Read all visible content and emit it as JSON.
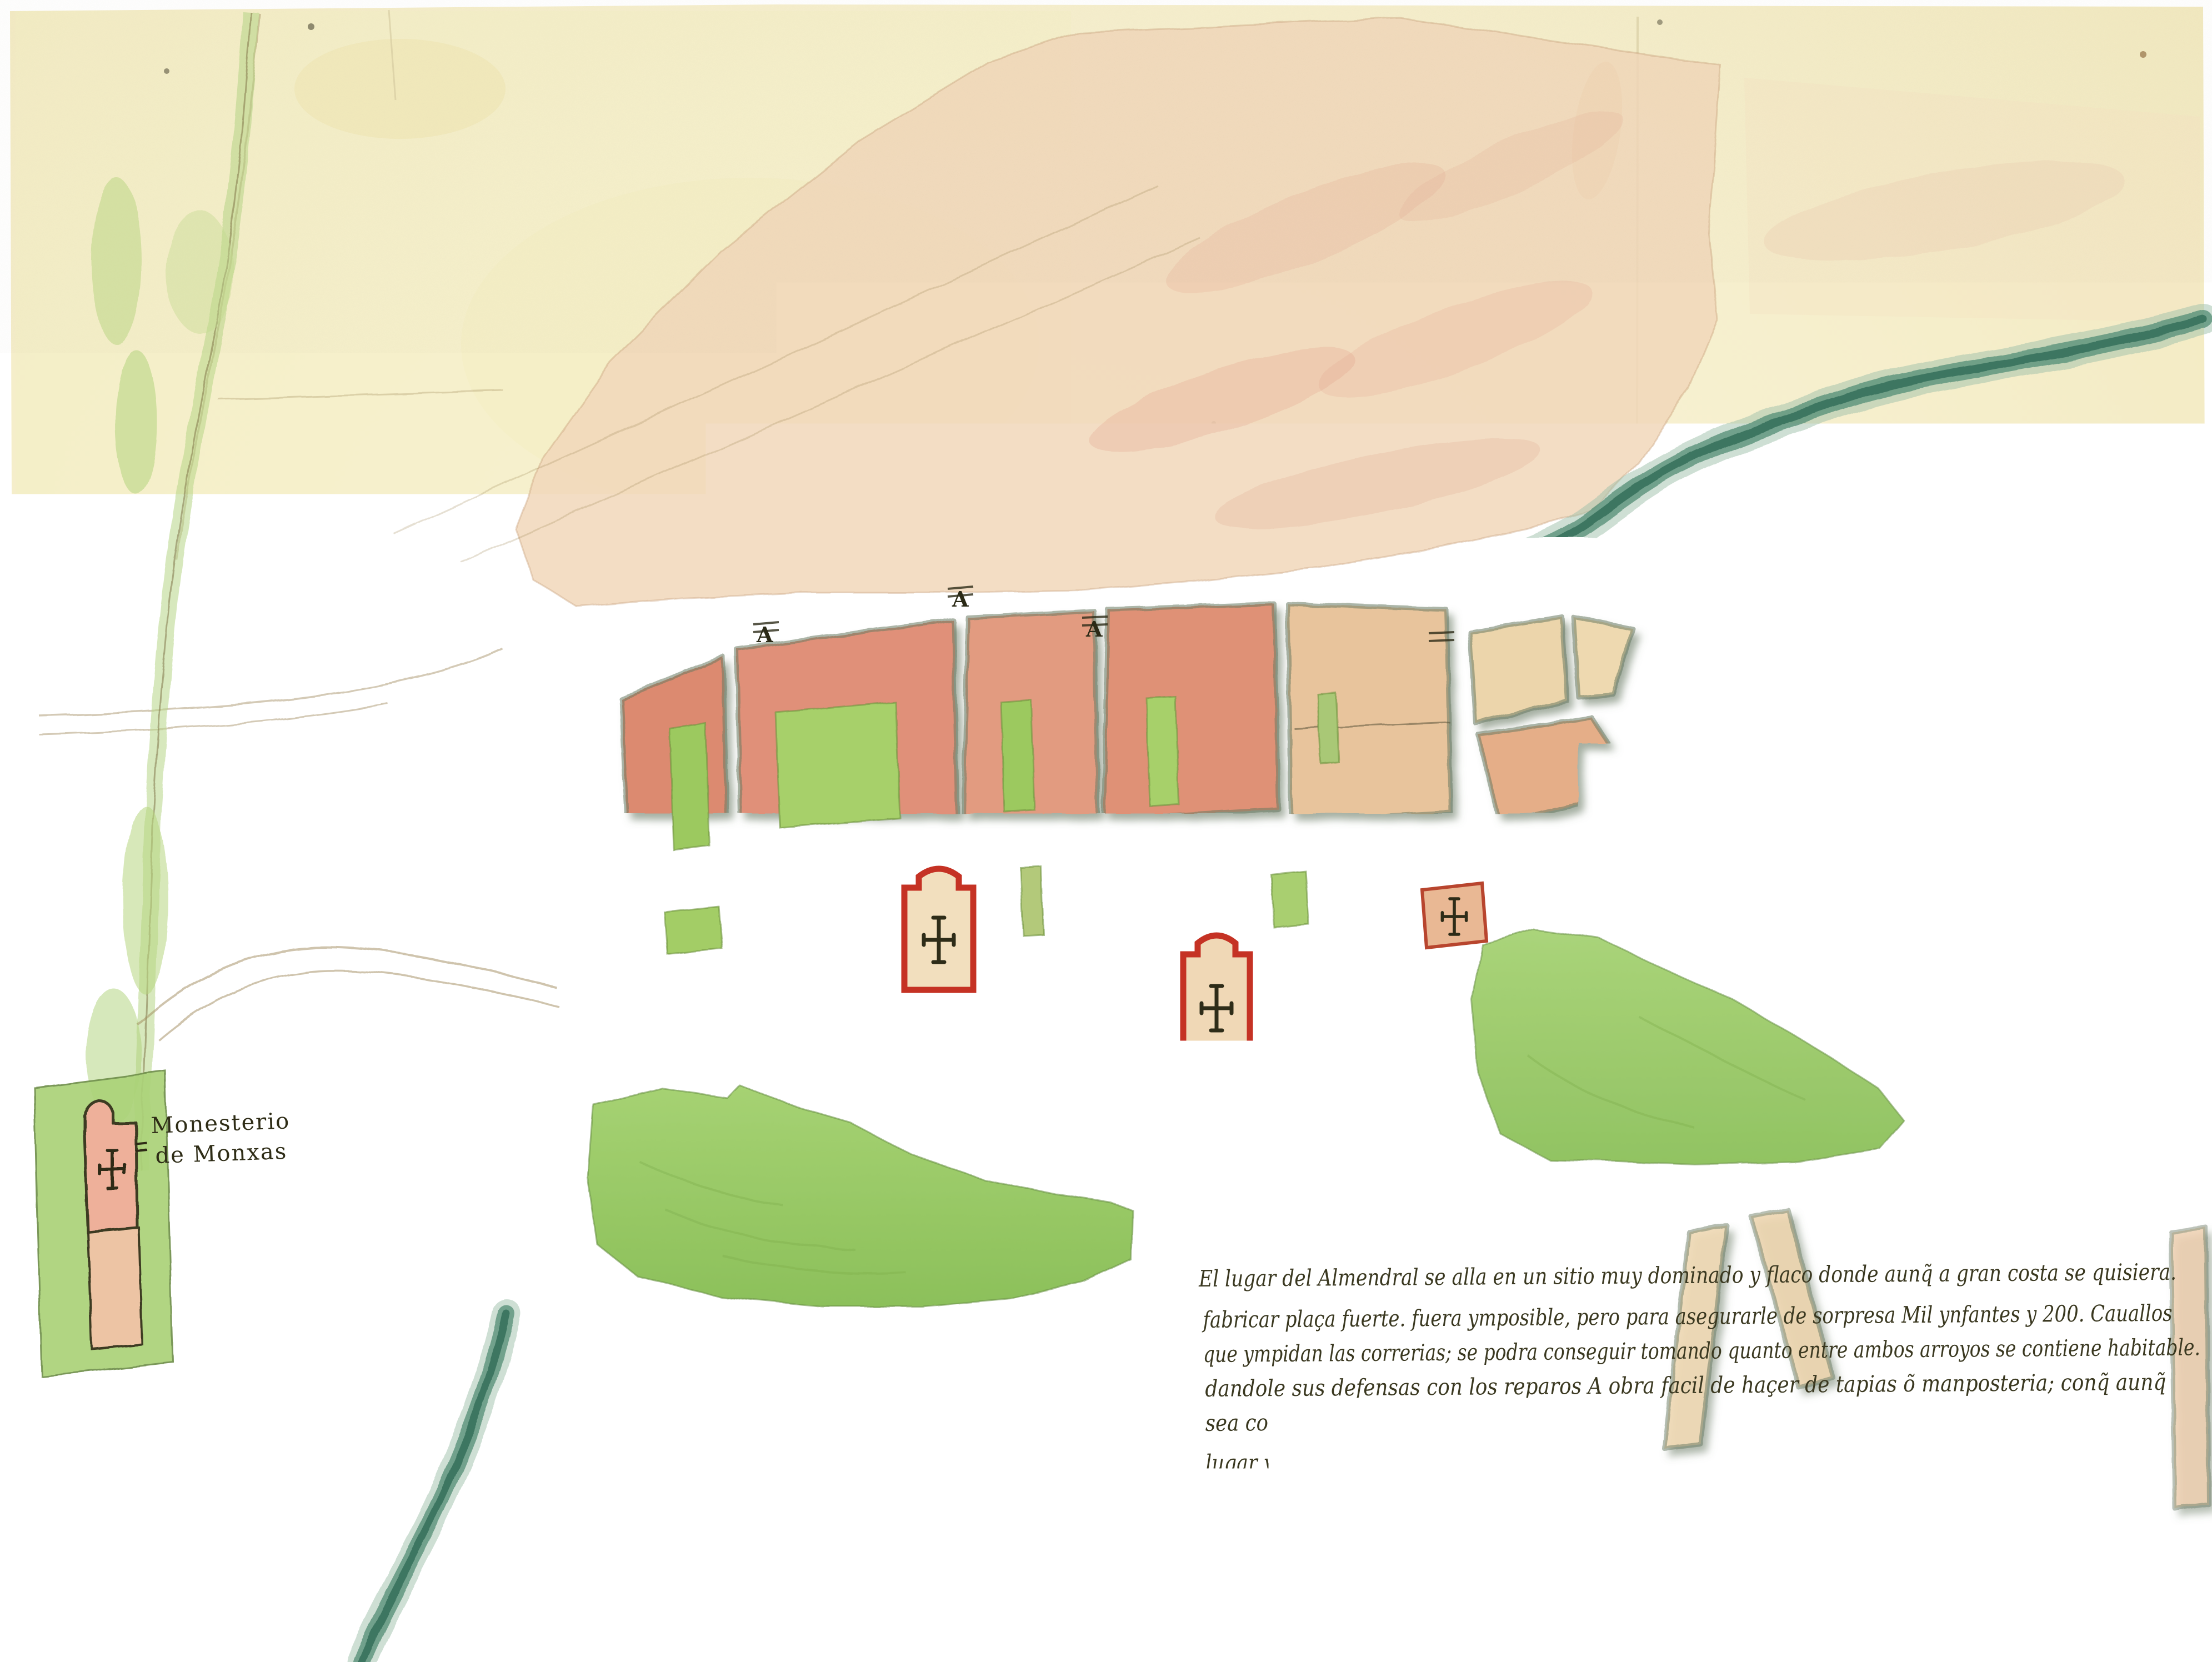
{
  "document": {
    "kind": "manuscript watercolor town plan",
    "watermark": "© National Archives: The Military Archives (Sweden)",
    "archive_number": "102"
  },
  "map": {
    "place_labels": {
      "torre": "Torre",
      "fuente": "Fuente.",
      "monesterio_line1": "Monesterio",
      "monesterio_line2": "de Monxas",
      "molino": "Molino"
    },
    "markers": {
      "a": "A",
      "b": "B",
      "ab": "AB"
    },
    "description_lines": [
      "El lugar del Almendral se alla en un sitio muy dominado y flaco donde aunq̃  a gran costa se quisiera.",
      "fabricar plaça fuerte. fuera ymposible,   pero para asegurarle de sorpresa  Mil ynfantes y 200. Cauallos",
      "que ympidan las correrias;  se podra conseguir tomando quanto entre ambos arroyos se contiene habitable.",
      "dandole sus defensas con los reparos   A    obra facil de haçer de tapias õ manposteria;   conq̃ aunq̃",
      "sea contenido de eminencias. pobladas de casas. estara tan seguro como bien defendido,        Este",
      "lugar y Nogales con la Albuquera y Barcarrota  de quien dista  2 leguas puedera impedir (teniendo",
      "el referido numero de gente)   las correrias de aquella parte con seguridad y facil modo.    oy esta",
      "ocupado con 25. soldados que asisten en la torre    con un sargento."
    ],
    "legend": [
      {
        "key": "A",
        "label": "Primeras trincheras."
      },
      {
        "key": "AB.B.",
        "label": "segundas. cortaduras."
      }
    ],
    "colors": {
      "paper": "#f6efcd",
      "river": "#3f7c65",
      "town_block": "#e59a7e",
      "garden": "#a3cd66",
      "meadow": "#9cc765",
      "church_outline": "#c53224",
      "ink": "#33311d",
      "watermark_gray": "#8c8c8c",
      "hill": "#f1d7ba"
    }
  }
}
